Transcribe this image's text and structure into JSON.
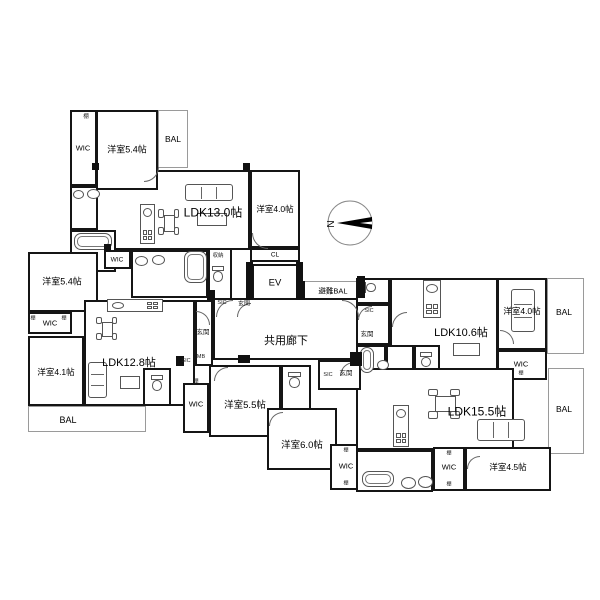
{
  "compass": {
    "label": "N"
  },
  "plan": {
    "rooms": [
      {
        "id": "a-ldk",
        "label": "LDK13.0帖",
        "x": 96,
        "y": 170,
        "w": 154,
        "h": 80,
        "lx": 213,
        "ly": 212,
        "fs": 12,
        "wall": "thick"
      },
      {
        "id": "a-y54",
        "label": "洋室5.4帖",
        "x": 96,
        "y": 110,
        "w": 62,
        "h": 80,
        "lx": 127,
        "ly": 149,
        "fs": 9,
        "wall": "thick"
      },
      {
        "id": "a-wic",
        "label": "WIC",
        "x": 70,
        "y": 110,
        "w": 27,
        "h": 76,
        "lx": 83,
        "ly": 148,
        "fs": 7.5,
        "wall": "thick"
      },
      {
        "id": "a-bal",
        "label": "BAL",
        "x": 158,
        "y": 110,
        "w": 30,
        "h": 58,
        "lx": 173,
        "ly": 139,
        "fs": 8.5,
        "wall": "thin"
      },
      {
        "id": "a-wash",
        "label": "",
        "x": 70,
        "y": 186,
        "w": 28,
        "h": 44,
        "lx": 0,
        "ly": 0,
        "fs": 0,
        "wall": "thick"
      },
      {
        "id": "a-bath",
        "label": "",
        "x": 70,
        "y": 230,
        "w": 46,
        "h": 42,
        "lx": 0,
        "ly": 0,
        "fs": 0,
        "wall": "thick"
      },
      {
        "id": "a-y40",
        "label": "洋室4.0帖",
        "x": 250,
        "y": 170,
        "w": 50,
        "h": 78,
        "lx": 275,
        "ly": 209,
        "fs": 8.5,
        "wall": "thick"
      },
      {
        "id": "a-cl",
        "label": "CL",
        "x": 250,
        "y": 248,
        "w": 50,
        "h": 14,
        "lx": 275,
        "ly": 255,
        "fs": 6.5,
        "wall": "thick"
      },
      {
        "id": "a-wash2",
        "label": "",
        "x": 131,
        "y": 250,
        "w": 77,
        "h": 48,
        "lx": 0,
        "ly": 0,
        "fs": 0,
        "wall": "thick"
      },
      {
        "id": "a-wc",
        "label": "",
        "x": 208,
        "y": 248,
        "w": 24,
        "h": 52,
        "lx": 0,
        "ly": 0,
        "fs": 0,
        "wall": "thick"
      },
      {
        "id": "elevator",
        "label": "EV",
        "x": 252,
        "y": 264,
        "w": 46,
        "h": 36,
        "lx": 275,
        "ly": 283,
        "fs": 9.5,
        "wall": "thick"
      },
      {
        "id": "hinan-bal",
        "label": "避難BAL",
        "x": 304,
        "y": 281,
        "w": 57,
        "h": 19,
        "lx": 333,
        "ly": 291,
        "fs": 7.5,
        "wall": "thin"
      },
      {
        "id": "corridor",
        "label": "共用廊下",
        "x": 213,
        "y": 298,
        "w": 148,
        "h": 62,
        "lx": 286,
        "ly": 340,
        "fs": 11,
        "wall": "thick"
      },
      {
        "id": "b-y54",
        "label": "洋室5.4帖",
        "x": 28,
        "y": 252,
        "w": 70,
        "h": 60,
        "lx": 62,
        "ly": 281,
        "fs": 9,
        "wall": "thick"
      },
      {
        "id": "b-wic1",
        "label": "WIC",
        "x": 104,
        "y": 250,
        "w": 27,
        "h": 19,
        "lx": 117,
        "ly": 260,
        "fs": 6.5,
        "wall": "thick"
      },
      {
        "id": "b-ldk",
        "label": "LDK12.8帖",
        "x": 84,
        "y": 300,
        "w": 111,
        "h": 106,
        "lx": 129,
        "ly": 362,
        "fs": 11,
        "wall": "thick"
      },
      {
        "id": "b-entry",
        "label": "",
        "x": 195,
        "y": 300,
        "w": 18,
        "h": 66,
        "lx": 0,
        "ly": 0,
        "fs": 0,
        "wall": "thick"
      },
      {
        "id": "b-wic2",
        "label": "WIC",
        "x": 28,
        "y": 312,
        "w": 44,
        "h": 22,
        "lx": 50,
        "ly": 323,
        "fs": 7.5,
        "wall": "thick"
      },
      {
        "id": "b-y41",
        "label": "洋室4.1帖",
        "x": 28,
        "y": 336,
        "w": 56,
        "h": 70,
        "lx": 56,
        "ly": 372,
        "fs": 8.5,
        "wall": "thick"
      },
      {
        "id": "b-wc",
        "label": "",
        "x": 143,
        "y": 368,
        "w": 28,
        "h": 38,
        "lx": 0,
        "ly": 0,
        "fs": 0,
        "wall": "thick"
      },
      {
        "id": "b-bal",
        "label": "BAL",
        "x": 28,
        "y": 406,
        "w": 118,
        "h": 26,
        "lx": 68,
        "ly": 420,
        "fs": 9,
        "wall": "thin"
      },
      {
        "id": "c-y55",
        "label": "洋室5.5帖",
        "x": 209,
        "y": 365,
        "w": 72,
        "h": 72,
        "lx": 245,
        "ly": 404,
        "fs": 9.5,
        "wall": "thick"
      },
      {
        "id": "c-toilet",
        "label": "",
        "x": 281,
        "y": 365,
        "w": 30,
        "h": 45,
        "lx": 0,
        "ly": 0,
        "fs": 0,
        "wall": "thick"
      },
      {
        "id": "c-y60",
        "label": "洋室6.0帖",
        "x": 267,
        "y": 408,
        "w": 70,
        "h": 62,
        "lx": 302,
        "ly": 444,
        "fs": 9.5,
        "wall": "thick"
      },
      {
        "id": "c-wic2",
        "label": "WIC",
        "x": 330,
        "y": 444,
        "w": 32,
        "h": 46,
        "lx": 346,
        "ly": 466,
        "fs": 7.5,
        "wall": "thick"
      },
      {
        "id": "c-wic",
        "label": "WIC",
        "x": 183,
        "y": 383,
        "w": 26,
        "h": 50,
        "lx": 196,
        "ly": 404,
        "fs": 7.5,
        "wall": "thick"
      },
      {
        "id": "d-ldk",
        "label": "LDK10.6帖",
        "x": 390,
        "y": 278,
        "w": 108,
        "h": 97,
        "lx": 461,
        "ly": 332,
        "fs": 11,
        "wall": "thick"
      },
      {
        "id": "d-wc1",
        "label": "",
        "x": 356,
        "y": 278,
        "w": 34,
        "h": 26,
        "lx": 0,
        "ly": 0,
        "fs": 0,
        "wall": "thick"
      },
      {
        "id": "d-entry",
        "label": "",
        "x": 356,
        "y": 304,
        "w": 34,
        "h": 41,
        "lx": 0,
        "ly": 0,
        "fs": 0,
        "wall": "thick"
      },
      {
        "id": "d-bath",
        "label": "",
        "x": 356,
        "y": 345,
        "w": 30,
        "h": 30,
        "lx": 0,
        "ly": 0,
        "fs": 0,
        "wall": "thick"
      },
      {
        "id": "d-wash",
        "label": "",
        "x": 386,
        "y": 345,
        "w": 28,
        "h": 30,
        "lx": 0,
        "ly": 0,
        "fs": 0,
        "wall": "thick"
      },
      {
        "id": "d-wc2",
        "label": "",
        "x": 414,
        "y": 345,
        "w": 26,
        "h": 30,
        "lx": 0,
        "ly": 0,
        "fs": 0,
        "wall": "thick"
      },
      {
        "id": "d-y40",
        "label": "洋室4.0帖",
        "x": 497,
        "y": 278,
        "w": 50,
        "h": 72,
        "lx": 522,
        "ly": 311,
        "fs": 8.5,
        "wall": "thick"
      },
      {
        "id": "d-bal",
        "label": "BAL",
        "x": 547,
        "y": 278,
        "w": 37,
        "h": 76,
        "lx": 564,
        "ly": 312,
        "fs": 8.5,
        "wall": "thin"
      },
      {
        "id": "d-wic",
        "label": "WIC",
        "x": 497,
        "y": 350,
        "w": 50,
        "h": 30,
        "lx": 521,
        "ly": 364,
        "fs": 7.5,
        "wall": "thick"
      },
      {
        "id": "e-ldk",
        "label": "LDK15.5帖",
        "x": 356,
        "y": 368,
        "w": 158,
        "h": 82,
        "lx": 477,
        "ly": 411,
        "fs": 12,
        "wall": "thick"
      },
      {
        "id": "e-entry",
        "label": "",
        "x": 318,
        "y": 360,
        "w": 43,
        "h": 30,
        "lx": 0,
        "ly": 0,
        "fs": 0,
        "wall": "thick"
      },
      {
        "id": "e-bal",
        "label": "BAL",
        "x": 548,
        "y": 368,
        "w": 36,
        "h": 86,
        "lx": 564,
        "ly": 409,
        "fs": 8.5,
        "wall": "thin"
      },
      {
        "id": "e-bath",
        "label": "",
        "x": 356,
        "y": 450,
        "w": 77,
        "h": 42,
        "lx": 0,
        "ly": 0,
        "fs": 0,
        "wall": "thick"
      },
      {
        "id": "e-wic",
        "label": "WIC",
        "x": 433,
        "y": 447,
        "w": 32,
        "h": 44,
        "lx": 449,
        "ly": 467,
        "fs": 7.5,
        "wall": "thick"
      },
      {
        "id": "e-y45",
        "label": "洋室4.5帖",
        "x": 465,
        "y": 447,
        "w": 86,
        "h": 44,
        "lx": 508,
        "ly": 467,
        "fs": 8.5,
        "wall": "thick"
      }
    ],
    "small_labels": [
      {
        "text": "棚",
        "x": 86,
        "y": 116,
        "fs": 5.5
      },
      {
        "text": "棚",
        "x": 33,
        "y": 318,
        "fs": 5
      },
      {
        "text": "棚",
        "x": 64,
        "y": 318,
        "fs": 5
      },
      {
        "text": "収納",
        "x": 218,
        "y": 255,
        "fs": 5.5
      },
      {
        "text": "SIC",
        "x": 222,
        "y": 303,
        "fs": 5.5
      },
      {
        "text": "玄関",
        "x": 244,
        "y": 303,
        "fs": 6
      },
      {
        "text": "玄関",
        "x": 203,
        "y": 331,
        "fs": 6.5
      },
      {
        "text": "MB",
        "x": 201,
        "y": 357,
        "fs": 5.5
      },
      {
        "text": "SIC",
        "x": 186,
        "y": 361,
        "fs": 5.5
      },
      {
        "text": "SIC",
        "x": 369,
        "y": 311,
        "fs": 5.5
      },
      {
        "text": "玄関",
        "x": 367,
        "y": 333,
        "fs": 6.5
      },
      {
        "text": "SIC",
        "x": 328,
        "y": 375,
        "fs": 5.5
      },
      {
        "text": "玄関",
        "x": 346,
        "y": 372,
        "fs": 6.5
      },
      {
        "text": "棚",
        "x": 196,
        "y": 381,
        "fs": 5
      },
      {
        "text": "棚",
        "x": 346,
        "y": 450,
        "fs": 5
      },
      {
        "text": "棚",
        "x": 346,
        "y": 483,
        "fs": 5
      },
      {
        "text": "棚",
        "x": 449,
        "y": 453,
        "fs": 5
      },
      {
        "text": "棚",
        "x": 449,
        "y": 484,
        "fs": 5
      },
      {
        "text": "棚",
        "x": 521,
        "y": 373,
        "fs": 5
      }
    ],
    "fixtures": [
      {
        "t": "sofa-h",
        "x": 185,
        "y": 184,
        "w": 48,
        "h": 17
      },
      {
        "t": "table",
        "x": 197,
        "y": 213,
        "w": 30,
        "h": 13
      },
      {
        "t": "kitchen-v",
        "x": 140,
        "y": 204,
        "w": 15,
        "h": 40
      },
      {
        "t": "dining-v",
        "x": 158,
        "y": 206,
        "w": 22,
        "h": 34
      },
      {
        "t": "oval",
        "x": 73,
        "y": 190,
        "w": 11,
        "h": 9
      },
      {
        "t": "oval",
        "x": 87,
        "y": 189,
        "w": 13,
        "h": 10
      },
      {
        "t": "tub",
        "x": 74,
        "y": 233,
        "w": 38,
        "h": 17
      },
      {
        "t": "tub",
        "x": 184,
        "y": 251,
        "w": 23,
        "h": 32
      },
      {
        "t": "oval",
        "x": 135,
        "y": 256,
        "w": 13,
        "h": 10
      },
      {
        "t": "oval",
        "x": 152,
        "y": 255,
        "w": 13,
        "h": 10
      },
      {
        "t": "toilet-v",
        "x": 212,
        "y": 266,
        "w": 12,
        "h": 16
      },
      {
        "t": "kitchen-h",
        "x": 107,
        "y": 299,
        "w": 56,
        "h": 13
      },
      {
        "t": "dining-v",
        "x": 96,
        "y": 314,
        "w": 22,
        "h": 30
      },
      {
        "t": "sofa-v",
        "x": 88,
        "y": 362,
        "w": 19,
        "h": 36
      },
      {
        "t": "table",
        "x": 120,
        "y": 376,
        "w": 20,
        "h": 13
      },
      {
        "t": "toilet-v",
        "x": 151,
        "y": 375,
        "w": 12,
        "h": 16
      },
      {
        "t": "toilet-v",
        "x": 288,
        "y": 372,
        "w": 13,
        "h": 16
      },
      {
        "t": "toilet-h",
        "x": 362,
        "y": 282,
        "w": 14,
        "h": 11
      },
      {
        "t": "kitchen-v",
        "x": 423,
        "y": 280,
        "w": 18,
        "h": 38
      },
      {
        "t": "sofa-v",
        "x": 511,
        "y": 289,
        "w": 24,
        "h": 43
      },
      {
        "t": "table",
        "x": 453,
        "y": 343,
        "w": 27,
        "h": 13
      },
      {
        "t": "tub",
        "x": 360,
        "y": 347,
        "w": 14,
        "h": 26
      },
      {
        "t": "oval",
        "x": 377,
        "y": 360,
        "w": 12,
        "h": 10
      },
      {
        "t": "toilet-v",
        "x": 420,
        "y": 352,
        "w": 12,
        "h": 15
      },
      {
        "t": "kitchen-v",
        "x": 393,
        "y": 405,
        "w": 16,
        "h": 42
      },
      {
        "t": "dining-h",
        "x": 424,
        "y": 388,
        "w": 42,
        "h": 32
      },
      {
        "t": "sofa-h",
        "x": 477,
        "y": 419,
        "w": 48,
        "h": 22
      },
      {
        "t": "tub",
        "x": 362,
        "y": 471,
        "w": 32,
        "h": 16
      },
      {
        "t": "oval",
        "x": 401,
        "y": 477,
        "w": 15,
        "h": 12
      },
      {
        "t": "oval",
        "x": 418,
        "y": 476,
        "w": 15,
        "h": 12
      },
      {
        "t": "arc",
        "x": 144,
        "y": 167,
        "w": 14,
        "h": 14,
        "r": 3
      },
      {
        "t": "arc",
        "x": 252,
        "y": 233,
        "w": 15,
        "h": 15,
        "r": 0
      },
      {
        "t": "arc",
        "x": 237,
        "y": 303,
        "w": 13,
        "h": 13,
        "r": 1
      },
      {
        "t": "arc",
        "x": 196,
        "y": 311,
        "w": 13,
        "h": 13,
        "r": 2
      },
      {
        "t": "arc",
        "x": 216,
        "y": 300,
        "w": 16,
        "h": 16,
        "r": 1
      },
      {
        "t": "arc",
        "x": 342,
        "y": 300,
        "w": 16,
        "h": 16,
        "r": 2
      },
      {
        "t": "arc",
        "x": 214,
        "y": 367,
        "w": 13,
        "h": 13,
        "r": 1
      },
      {
        "t": "arc",
        "x": 269,
        "y": 412,
        "w": 13,
        "h": 13,
        "r": 1
      },
      {
        "t": "arc",
        "x": 358,
        "y": 306,
        "w": 13,
        "h": 13,
        "r": 1
      },
      {
        "t": "arc",
        "x": 392,
        "y": 312,
        "w": 14,
        "h": 14,
        "r": 1
      },
      {
        "t": "arc",
        "x": 340,
        "y": 362,
        "w": 13,
        "h": 13,
        "r": 1
      },
      {
        "t": "arc",
        "x": 500,
        "y": 330,
        "w": 13,
        "h": 13,
        "r": 2
      },
      {
        "t": "arc",
        "x": 467,
        "y": 456,
        "w": 12,
        "h": 12,
        "r": 1
      },
      {
        "t": "col",
        "x": 246,
        "y": 262,
        "w": 7,
        "h": 38
      },
      {
        "t": "col",
        "x": 296,
        "y": 262,
        "w": 7,
        "h": 38
      },
      {
        "t": "col",
        "x": 298,
        "y": 281,
        "w": 7,
        "h": 19
      },
      {
        "t": "col",
        "x": 357,
        "y": 276,
        "w": 8,
        "h": 22
      },
      {
        "t": "col",
        "x": 207,
        "y": 290,
        "w": 8,
        "h": 10
      },
      {
        "t": "col",
        "x": 238,
        "y": 355,
        "w": 12,
        "h": 8
      },
      {
        "t": "col",
        "x": 350,
        "y": 352,
        "w": 12,
        "h": 14
      },
      {
        "t": "col",
        "x": 176,
        "y": 356,
        "w": 8,
        "h": 10
      },
      {
        "t": "col",
        "x": 92,
        "y": 163,
        "w": 7,
        "h": 7
      },
      {
        "t": "col",
        "x": 243,
        "y": 163,
        "w": 7,
        "h": 7
      },
      {
        "t": "col",
        "x": 104,
        "y": 244,
        "w": 7,
        "h": 7
      }
    ]
  }
}
